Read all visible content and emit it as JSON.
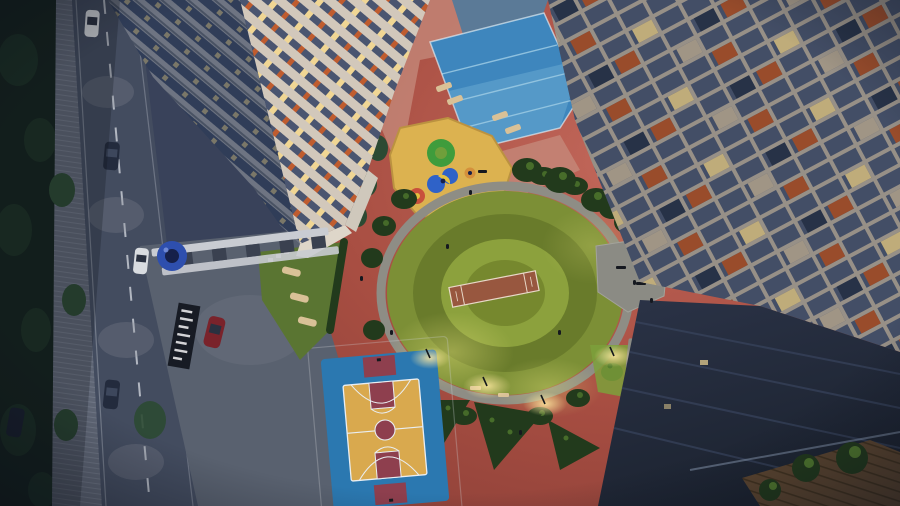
{
  "scene": {
    "type": "aerial-architectural-render",
    "time_of_day": "dusk",
    "description": "Bird's-eye dusk rendering of a residential complex amenity podium: circular central lawn with a cricket practice pitch, children's playground with yellow safety surface, swimming pool with lane lines and lounger deck, blue-and-yellow basketball court, grey seating plaza, landscaped hedges, an entrance gate with pergola, signage wall and blue canopy kiosk, a tree-lined road with cars and street lamps, cream high-rise towers with slate windows and orange accent panels, and a dark foreground rooftop balcony with potted plants and a wooden deck.",
    "elements": {
      "forest": "dense dark trees along the left street edge",
      "road": "two-lane road with dashed centerline, paved sidewalk, lamp light pools, five cars",
      "left_towers": "two cream towers seen from above with blue balcony bands, lit windows and orange accents",
      "right_tower": "tall facade grid of slate windows, cream mullions, scattered orange panels and lit flats",
      "pool": "bright blue swimming pool with pale lane lines, dark reflecting pool behind a stone planting band, pink deck with sun loungers",
      "playground": "yellow rubber surface with green mound, blue twin slides with yellow wedge, red carousel and orange spinner",
      "central_lawn": "large circular lawn with concentric mowing rings, brown cricket pitch, perimeter walking path, lamp glows, benches",
      "seating_plaza": "grey chamfered seating deck east of the lawn plus a small bench pad",
      "basketball_court": "blue court with golden inner floor, maroon keys, centre circle and end zones, white markings",
      "entrance": "white pergola gate over driveway, dark signage wall with white lettering bars, round blue canopy kiosk, red car entering",
      "lawn_triangle": "small lawn with hammock loungers and stepping stones near the gate",
      "dark_building": "foreground dark podium roof and balcony with glass rail, wooden planks and potted plants"
    }
  },
  "colors": {
    "base": "#39425a",
    "forest": "#15231e",
    "forestHi": "#24402c",
    "shrub": "#2c4a33",
    "road": "#434c5f",
    "roadLit": "#868a93",
    "roadLine": "#ced2da",
    "sidewalk": "#5f6675",
    "plaza": "#59616f",
    "deck": "#a84e42",
    "deckLight": "#c1675a",
    "deckDark": "#8c4038",
    "deckPink": "#c58b7c",
    "towerCream": "#d2c8bb",
    "towerShade": "#8f95a3",
    "balconyBlue": "#3c4b6b",
    "windowSlate": "#4a5570",
    "windowSlate2": "#515e7a",
    "rightMullion": "#bdb2a5",
    "accentOrange": "#bf5c2f",
    "litWindow": "#f0d694",
    "litWindow2": "#c8b9a2",
    "windowDark": "#2e3a52",
    "podiumWhite": "#ded6c9",
    "poolDark": "#5b7a97",
    "poolBlue": "#3e86bd",
    "poolLight": "#79b7d9",
    "laneLine": "#9ccbe4",
    "poolEdge": "#e8f2f8",
    "stoneBand": "#202c34",
    "lounger": "#d9c197",
    "playYellow": "#dcb250",
    "playYellowRim": "#bb9240",
    "playGreen": "#3f9c3c",
    "playBlue": "#2f62c8",
    "playYellow2": "#e4c040",
    "playRed": "#c8503c",
    "playOrange": "#d4903c",
    "lawnOuter": "#7c8f36",
    "lawnRing": "#697b2b",
    "lawnMid": "#8ca13d",
    "lawnInner": "#76882e",
    "lawnGlow": "#e6e37a",
    "pitch": "#98573f",
    "pitchLine": "#e8d8c8",
    "path": "#8e8d85",
    "plazaPad": "#8b8b84",
    "hedge": "#223a1c",
    "hedgeHi": "#517a2e",
    "hedgeLit": "#7ca03b",
    "courtBlue": "#2b78b0",
    "courtYellow": "#d9a94e",
    "courtMaroon": "#8e3f4e",
    "courtLine": "#e9eef2",
    "darkBuild": "#2b3347",
    "darkBuild2": "#1c2330",
    "ridge": "#3a4660",
    "glass": "#8fa0b8",
    "wood": "#5d4630",
    "woodLine": "#43331f",
    "plantPot": "#14181c",
    "signage": "#171b24",
    "signText": "#e8e8ea",
    "canopy": "#2e4fae",
    "canopyDark": "#16204a",
    "pergola": "#c9ccd2",
    "carWhite": "#d9dce0",
    "carDark": "#232b3d",
    "carRed": "#7a232b",
    "carGlass": "#2a3140",
    "person": "#15181f",
    "lampGlow": "#ffe9a0",
    "vignette": "#0a0e18"
  }
}
